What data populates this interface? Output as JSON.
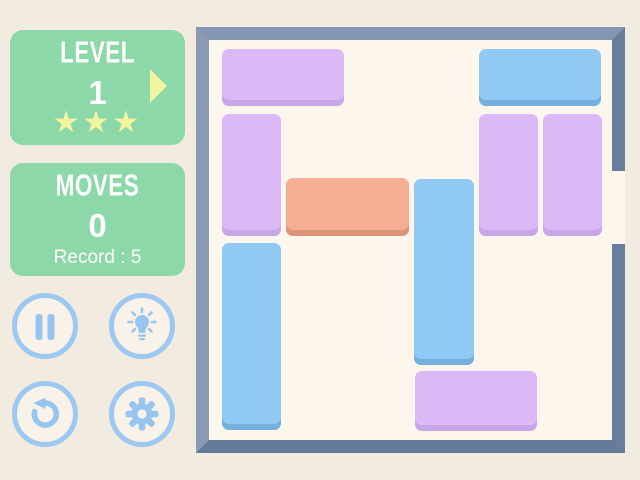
{
  "hud": {
    "level": {
      "title": "LEVEL",
      "value": "1",
      "stars_count": 3,
      "stars_display": "★★★",
      "next_arrow_icon": "next-level-arrow-icon"
    },
    "moves": {
      "title": "MOVES",
      "value": "0",
      "record_label": "Record : 5"
    },
    "buttons": [
      {
        "name": "pause",
        "icon": "pause-icon"
      },
      {
        "name": "hint",
        "icon": "lightbulb-icon"
      },
      {
        "name": "restart",
        "icon": "restart-icon"
      },
      {
        "name": "settings",
        "icon": "gear-icon"
      }
    ]
  },
  "board": {
    "grid": {
      "cols": 6,
      "rows": 6
    },
    "exit": {
      "side": "right",
      "row": 2
    },
    "palette": {
      "purple": {
        "fill": "#DCB8F7",
        "shadow": "#C8A6E7"
      },
      "blue": {
        "fill": "#8FC9F4",
        "shadow": "#75AFDE"
      },
      "orange": {
        "fill": "#F6AE93",
        "shadow": "#DE9279"
      }
    },
    "blocks": [
      {
        "id": "purple-h-top-left",
        "color": "purple",
        "col": 0,
        "row": 0,
        "len": 2,
        "dir": "h",
        "x": 13,
        "y": 9,
        "w": 122,
        "h": 57
      },
      {
        "id": "blue-h-top-right",
        "color": "blue",
        "col": 4,
        "row": 0,
        "len": 2,
        "dir": "h",
        "x": 270,
        "y": 9,
        "w": 122,
        "h": 57
      },
      {
        "id": "purple-v-left",
        "color": "purple",
        "col": 0,
        "row": 1,
        "len": 2,
        "dir": "v",
        "x": 13,
        "y": 74,
        "w": 59,
        "h": 122
      },
      {
        "id": "purple-v-mid-right",
        "color": "purple",
        "col": 4,
        "row": 1,
        "len": 2,
        "dir": "v",
        "x": 270,
        "y": 74,
        "w": 59,
        "h": 122
      },
      {
        "id": "purple-v-far-right",
        "color": "purple",
        "col": 5,
        "row": 1,
        "len": 2,
        "dir": "v",
        "x": 334,
        "y": 74,
        "w": 59,
        "h": 122
      },
      {
        "id": "key-block-orange",
        "color": "orange",
        "col": 1,
        "row": 2,
        "len": 2,
        "dir": "h",
        "x": 77,
        "y": 138,
        "w": 123,
        "h": 58,
        "key": true
      },
      {
        "id": "blue-v-center",
        "color": "blue",
        "col": 3,
        "row": 2,
        "len": 3,
        "dir": "v",
        "x": 205,
        "y": 139,
        "w": 60,
        "h": 186
      },
      {
        "id": "blue-v-bottom-left",
        "color": "blue",
        "col": 0,
        "row": 3,
        "len": 3,
        "dir": "v",
        "x": 13,
        "y": 203,
        "w": 59,
        "h": 187
      },
      {
        "id": "purple-h-bottom",
        "color": "purple",
        "col": 3,
        "row": 5,
        "len": 2,
        "dir": "h",
        "x": 206,
        "y": 331,
        "w": 122,
        "h": 60
      }
    ]
  },
  "colors": {
    "page_background": "#F2EBE0",
    "panel_green": "#8CD8A8",
    "panel_text": "#FFFFFF",
    "accent_yellow": "#F1F59F",
    "button_blue": "#9CC8F1",
    "button_fill": "#F8F2E8",
    "board_frame": "#7A8CA6",
    "board_interior": "#FDF6EC"
  }
}
